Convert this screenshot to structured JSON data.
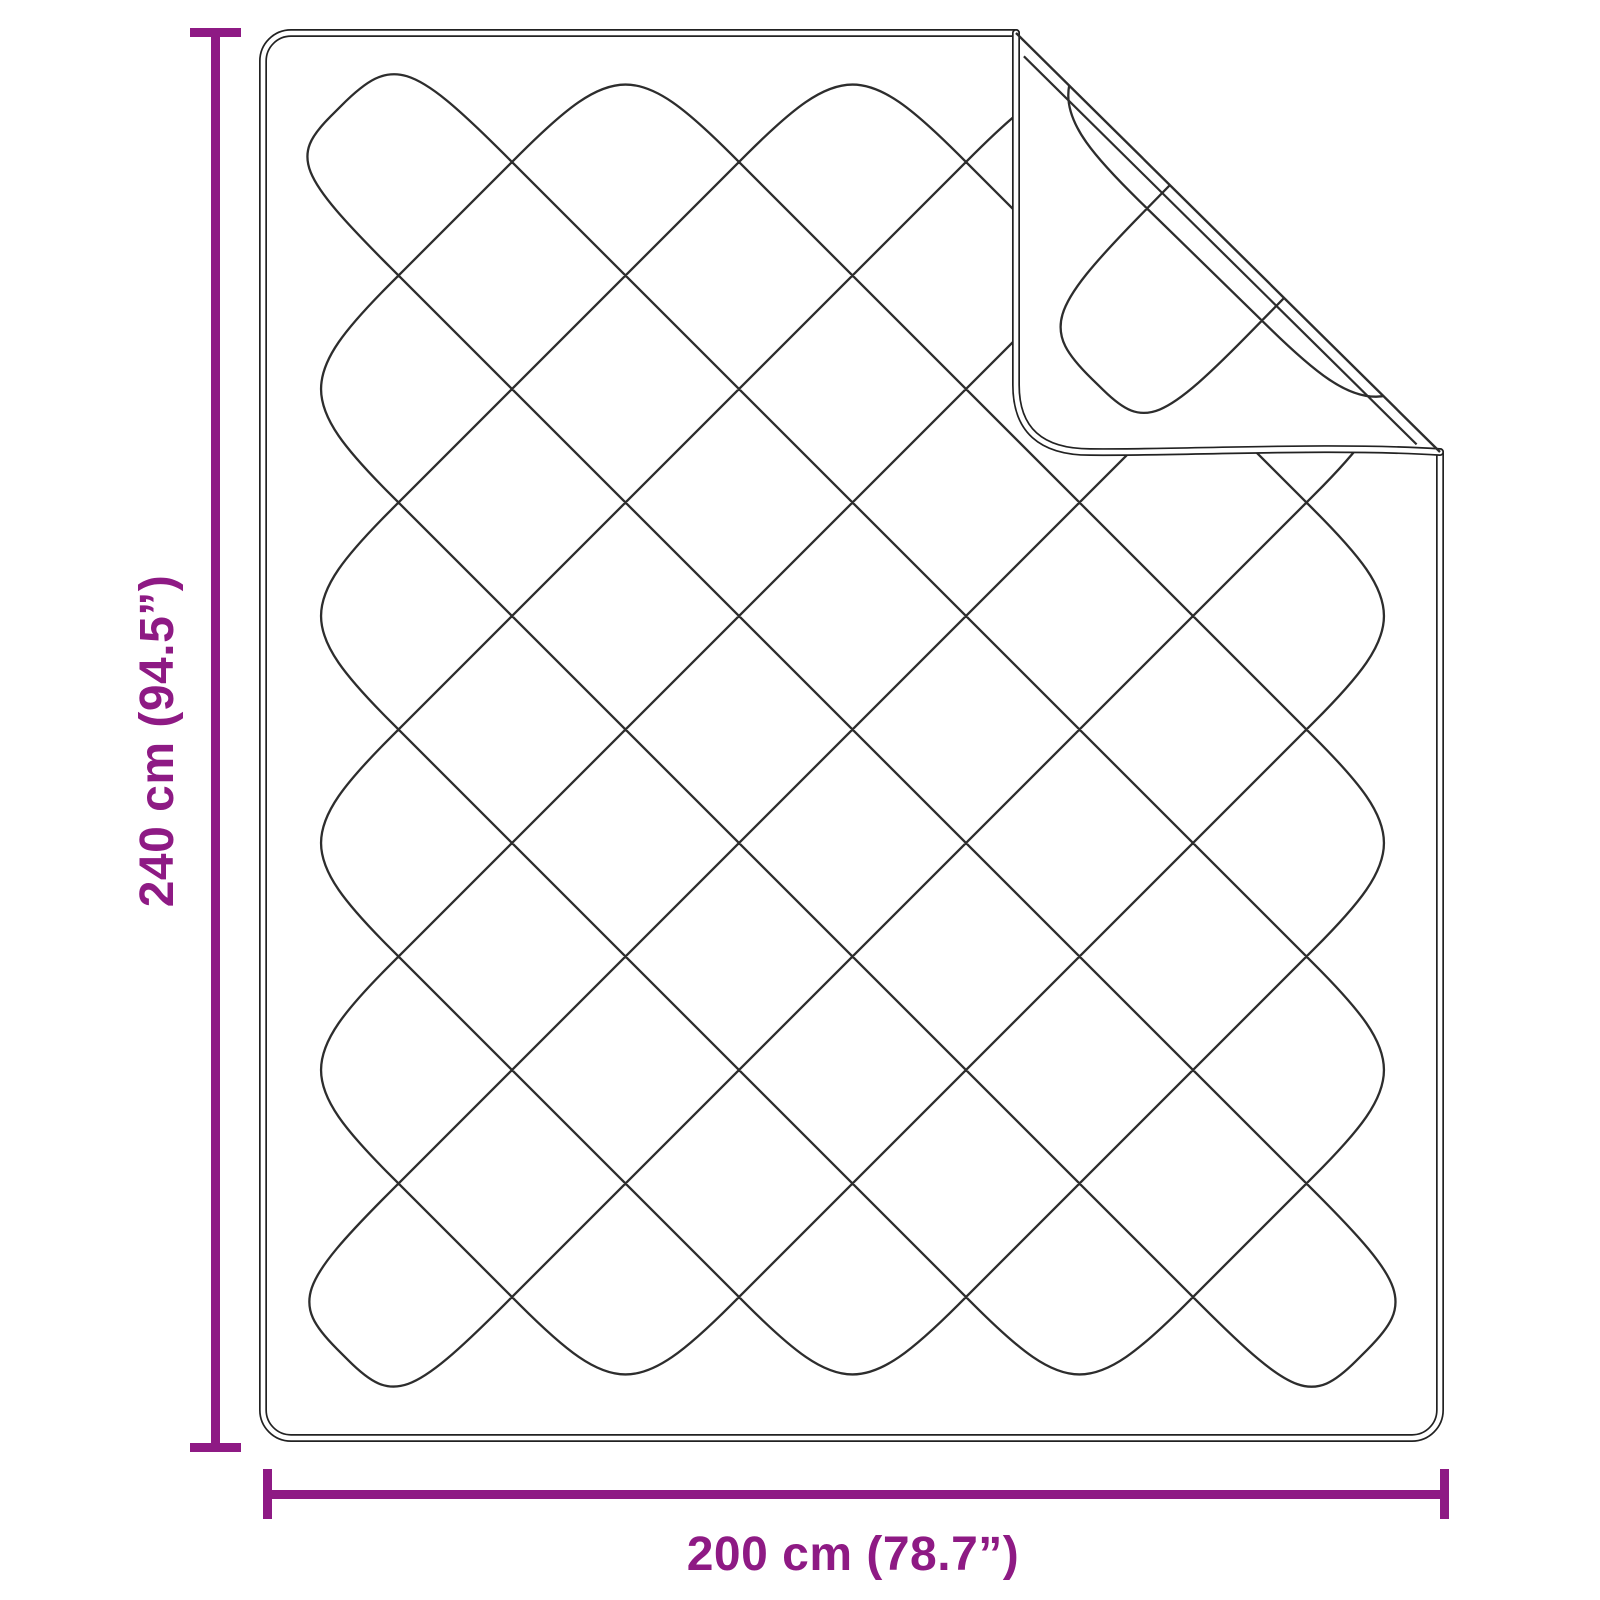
{
  "diagram": {
    "vertical_dimension": {
      "label": "240 cm (94.5”)"
    },
    "horizontal_dimension": {
      "label": "200 cm (78.7”)"
    },
    "colors": {
      "dimension": "#8e1a84",
      "stitch_line": "#2d2d2d",
      "outline": "#222222",
      "background": "#ffffff"
    }
  }
}
